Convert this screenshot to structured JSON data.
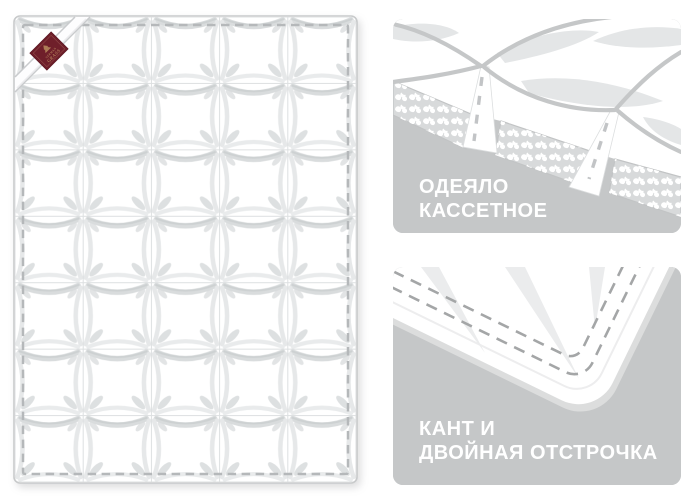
{
  "page": {
    "background_color": "#ffffff"
  },
  "duvet_overview": {
    "description": "quilted cassette duvet seen from above, 5x7 puffed squares, dashed stitch border, corner strap with brand tag",
    "quilt_grid": {
      "columns": 5,
      "rows": 7
    },
    "brand_label": {
      "line1": "GERMAN",
      "line2": "GRASS",
      "bg_color": "#6f1f2a",
      "text_color": "#c9a06b"
    },
    "colors": {
      "fabric": "#ffffff",
      "outline": "#c8cacb",
      "stitch_dashes": "#b5b8ba",
      "quilt_shading": "#d3d6d7"
    }
  },
  "detail_panels": {
    "bg_color": "#c5c7c8",
    "text_color": "#ffffff",
    "cassette": {
      "title_line1": "ОДЕЯЛО",
      "title_line2": "КАССЕТНОЕ"
    },
    "edging": {
      "title_line1": "КАНТ И",
      "title_line2": "ДВОЙНАЯ ОТСТРОЧКА"
    }
  }
}
